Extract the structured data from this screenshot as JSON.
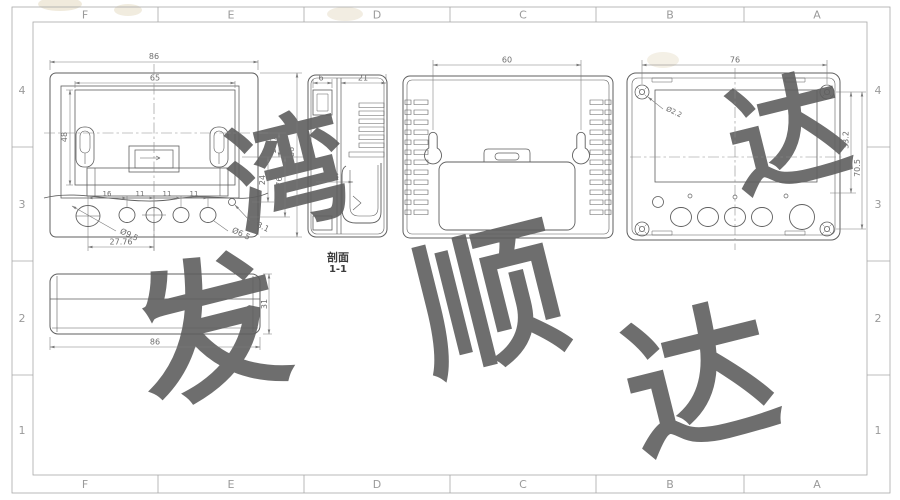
{
  "sheet": {
    "top_labels": [
      "F",
      "E",
      "D",
      "C",
      "B",
      "A"
    ],
    "bottom_labels": [
      "F",
      "E",
      "D",
      "C",
      "B",
      "A"
    ],
    "left_labels": [
      "4",
      "3",
      "2",
      "1"
    ],
    "right_labels": [
      "4",
      "3",
      "2",
      "1"
    ],
    "line_color": "#5f5f5f",
    "dim_color": "#7a7a7a"
  },
  "front_view": {
    "dim_width": "86",
    "dim_window_w": "65",
    "dim_window_h": "48",
    "dim_height": "86",
    "dim_10_7": "10.7",
    "dim_24": "24",
    "dim_31_76": "31.76",
    "pitch": [
      "16",
      "11",
      "11",
      "11"
    ],
    "dim_span": "27.76",
    "dia_big": "Ø9.5",
    "dia_small": "Ø6.5",
    "dia_tiny": "Ø3.1"
  },
  "section_view": {
    "label_line1": "剖面",
    "label_line2": "1-1",
    "dim_lip": "6",
    "dim_body": "21",
    "dim_inner": "11.3"
  },
  "back_view": {
    "dim_keyhole_pitch": "60"
  },
  "inside_view": {
    "dim_width": "76",
    "dia_screw": "Ø2.2",
    "dim_v1": "33.2",
    "dim_v2": "70.5"
  },
  "profile_view": {
    "dim_width": "86",
    "dim_height": "31"
  },
  "watermark": {
    "chars": [
      "发",
      "顺",
      "达",
      "湾",
      "达"
    ]
  }
}
